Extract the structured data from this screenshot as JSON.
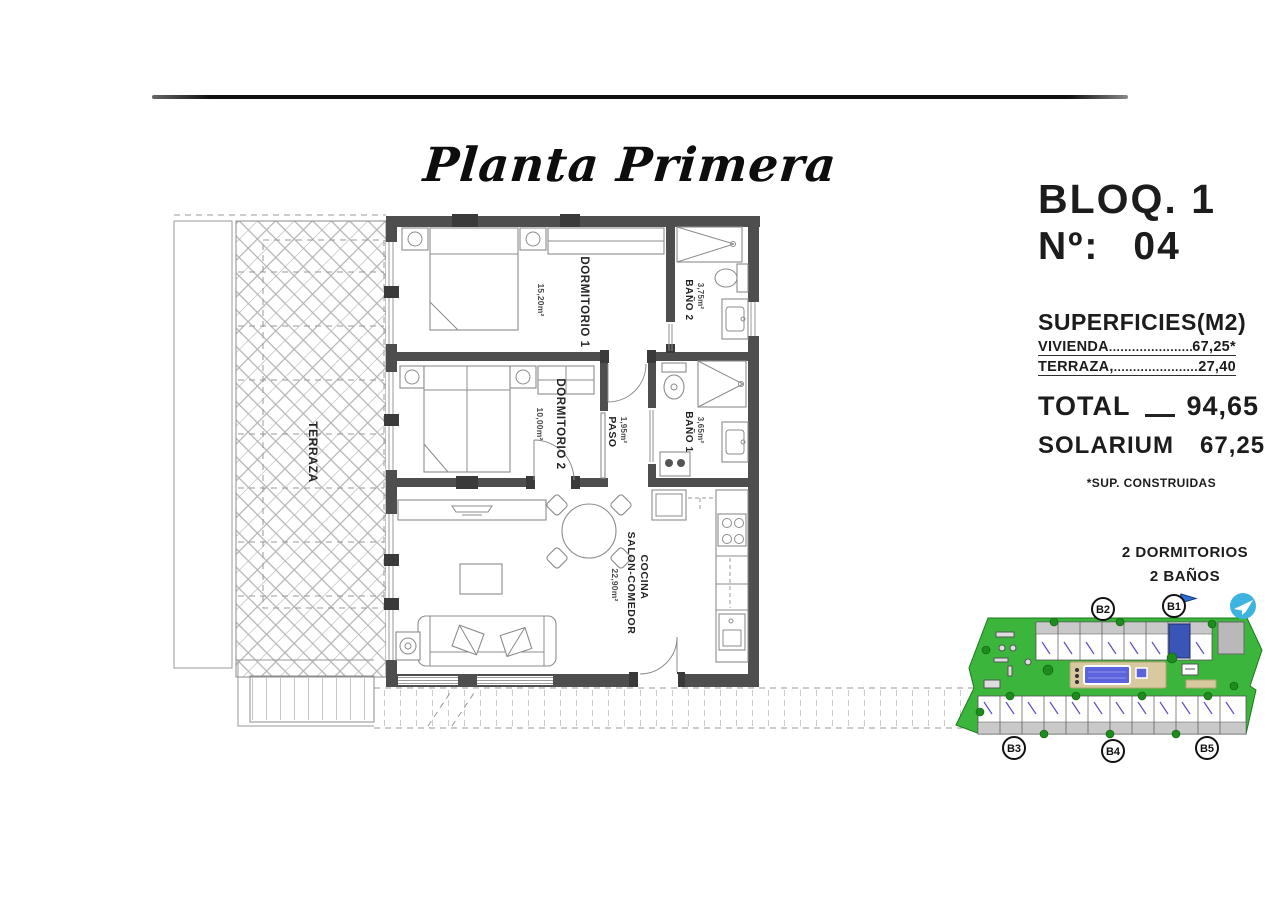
{
  "title": "Planta Primera",
  "panel": {
    "bloq": "BLOQ. 1",
    "numero_label": "Nº:",
    "numero_value": "04",
    "superficies_heading": "SUPERFICIES(M2)",
    "rows": [
      {
        "label": "VIVIENDA",
        "leader": "............................",
        "value": "67,25*"
      },
      {
        "label": "TERRAZA,",
        "leader": "............................",
        "value": "27,40"
      }
    ],
    "total_label": "TOTAL",
    "total_value": "94,65",
    "solarium_label": "SOLARIUM",
    "solarium_value": "67,25",
    "footnote": "*SUP. CONSTRUIDAS",
    "features": [
      "2 DORMITORIOS",
      "2 BAÑOS"
    ]
  },
  "plan": {
    "rooms": {
      "dormitorio1": {
        "name": "DORMITORIO 1",
        "area": "15,20m²"
      },
      "dormitorio2": {
        "name": "DORMITORIO 2",
        "area": "10,00m²"
      },
      "bano1": {
        "name": "BAÑO 1",
        "area": "3,65m²"
      },
      "bano2": {
        "name": "BAÑO 2",
        "area": "3,75m²"
      },
      "paso": {
        "name": "PASO",
        "area": "1,95m²"
      },
      "cocina_salon": {
        "name_line1": "COCINA",
        "name_line2": "SALON-COMEDOR",
        "area": "22,90m²"
      },
      "terraza": {
        "name": "TERRAZA"
      }
    }
  },
  "sitemap": {
    "blocks": [
      {
        "label": "B2"
      },
      {
        "label": "B1"
      },
      {
        "label": "B3"
      },
      {
        "label": "B4"
      },
      {
        "label": "B5"
      }
    ],
    "highlighted_block": "B1",
    "highlighted_unit": "04"
  },
  "colors": {
    "site_green": "#3cb53c",
    "pool_blue": "#5c63dd",
    "highlight_unit_blue": "#3a55b8",
    "logo_blue": "#3db4e0",
    "wall_gray": "#4e4e4e"
  }
}
